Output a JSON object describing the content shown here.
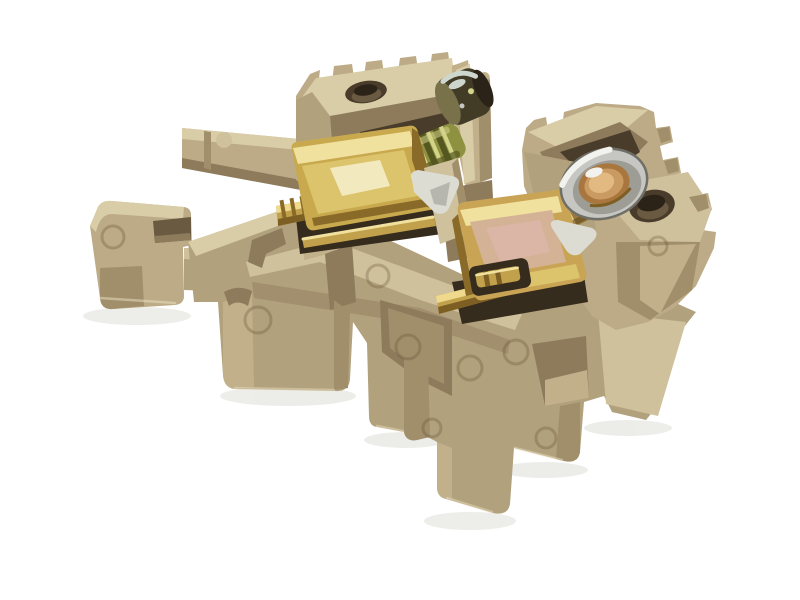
{
  "meta": {
    "type": "product-photo",
    "subject": "Beige DIN-rail screw terminal block with two brass screw clamp contacts on a white background",
    "background": "#ffffff"
  },
  "parts": [
    "left-din-clip",
    "upper-left-arm",
    "lower-left-arm",
    "main-body",
    "left-terminal-block",
    "left-clamp",
    "left-busbar",
    "left-screw-threads",
    "left-screw-head",
    "center-post",
    "divider-wedge",
    "right-terminal-block",
    "right-clamp",
    "right-busbar",
    "right-screw-threads",
    "right-screw-washer",
    "right-screw-head",
    "rail-flange-hole",
    "wire-entry-hole",
    "mounting-feet",
    "mold-marks"
  ],
  "palette": {
    "bg": "#ffffff",
    "floor_shadow": "#ebebe7",
    "plastic_top": "#d9cda8",
    "plastic_light": "#cfc19c",
    "plastic_mid": "#c1b08a",
    "plastic_base": "#bcab86",
    "plastic_front": "#b2a17d",
    "plastic_side": "#a18f6c",
    "plastic_shade": "#8d7b5c",
    "plastic_deep": "#6b5a42",
    "cavity": "#4a3c2a",
    "cavity_dark": "#362c1e",
    "hole_dark": "#2c2318",
    "edge_hi": "#ece3c4",
    "brass_hi": "#eed98c",
    "brass": "#c2a14c",
    "brass_dark": "#7d5f24",
    "gold_hi": "#f0e19e",
    "gold": "#c9a94e",
    "gold_mid": "#dcc46c",
    "gold_dark": "#8a6a28",
    "specular": "#f5edc8",
    "irid_base": "#c9a455",
    "irid_face": "#d4b295",
    "irid_pink": "#ddb5ab",
    "bronze": "#9a7a3a",
    "bronze_dark": "#5f4a1e",
    "bronze_hi": "#e6cd8d",
    "steel_hi": "#f2f2ee",
    "steel": "#c6c6c2",
    "steel_mid": "#9d9d96",
    "steel_dark": "#6f6f68",
    "copper": "#a9763d",
    "copper_mid": "#c99a62",
    "copper_hi": "#e2ba81",
    "olive": "#8e9140",
    "olive_dark": "#54571f",
    "olive_hi": "#d3d489",
    "head_dark": "#423c26",
    "head_face": "#787149",
    "glint": "#ced7cd",
    "white_metal": "#dcdcd2",
    "mold_ring": "rgba(92,72,44,0.28)"
  }
}
